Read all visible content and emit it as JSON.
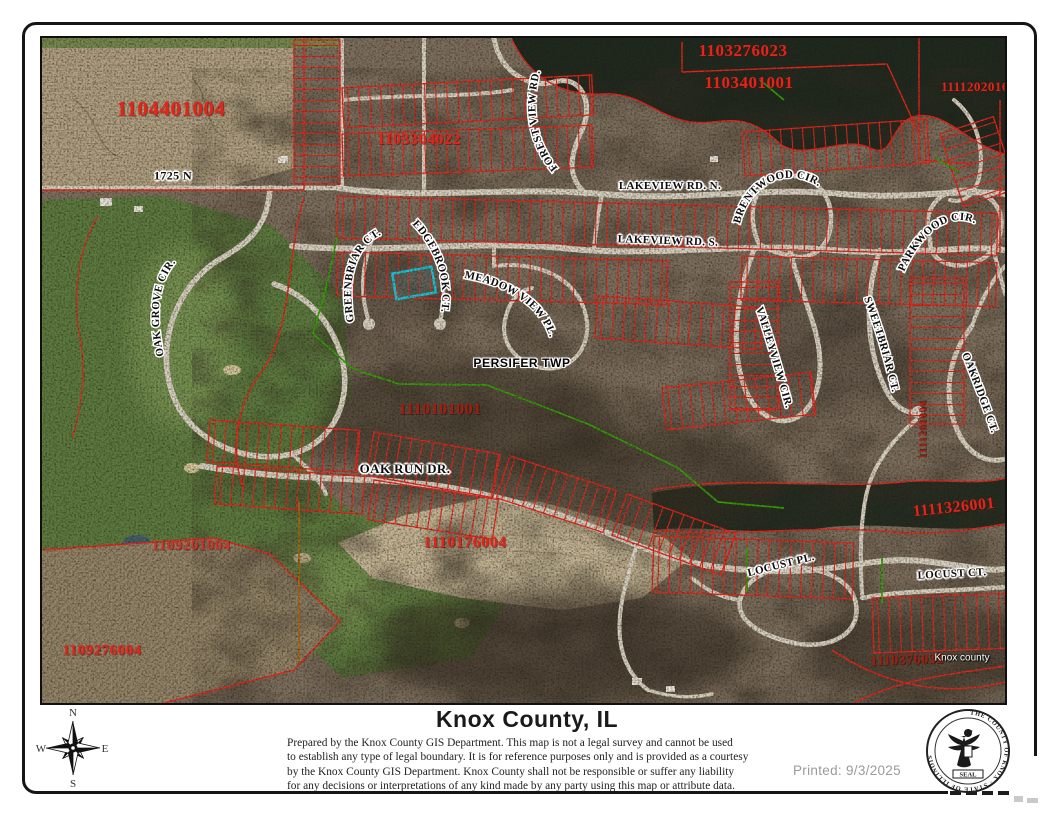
{
  "footer": {
    "title": "Knox County, IL",
    "disclaimer_lines": [
      "Prepared by the Knox County GIS Department. This map is not a legal survey and cannot be used",
      "to establish any type of legal boundary. It is for reference purposes only and is provided as a courtesy",
      "by the Knox County GIS Department.  Knox County shall not be responsible or suffer any liability",
      "for any decisions or interpretations of any kind made by any party using this map or attribute data."
    ],
    "printed_label": "Printed: 9/3/2025",
    "compass": {
      "n": "N",
      "e": "E",
      "s": "S",
      "w": "W"
    },
    "seal": {
      "ring_text": "THE COUNTY OF KNOX · STATE OF ILLINOIS",
      "banner": "SEAL"
    }
  },
  "map": {
    "highlight_color": "#1ac8dc",
    "parcel_line_color": "#e8261c",
    "labels": [
      {
        "name": "parcel-label-1104401004",
        "text": "1104401004",
        "cls": "parcel",
        "x": 129,
        "y": 71,
        "size": 21
      },
      {
        "name": "parcel-label-1103276023",
        "text": "1103276023",
        "cls": "parcel",
        "x": 701,
        "y": 13,
        "size": 17
      },
      {
        "name": "parcel-label-1103401001",
        "text": "1103401001",
        "cls": "parcel",
        "x": 707,
        "y": 45,
        "size": 17
      },
      {
        "name": "parcel-label-1111202016",
        "text": "1111202016",
        "cls": "parcel",
        "x": 933,
        "y": 49,
        "size": 13
      },
      {
        "name": "parcel-label-1103304022",
        "text": "1103304022",
        "cls": "parcel",
        "x": 377,
        "y": 102,
        "size": 16
      },
      {
        "name": "parcel-label-1110101001",
        "text": "1110101001",
        "cls": "parcel dark",
        "x": 398,
        "y": 372,
        "size": 16
      },
      {
        "name": "parcel-label-1110176004",
        "text": "1110176004",
        "cls": "parcel",
        "x": 423,
        "y": 505,
        "size": 16
      },
      {
        "name": "parcel-label-1109201004",
        "text": "1109201004",
        "cls": "parcel dim",
        "x": 149,
        "y": 508,
        "size": 15
      },
      {
        "name": "parcel-label-1109276004",
        "text": "1109276004",
        "cls": "parcel",
        "x": 60,
        "y": 613,
        "size": 15
      },
      {
        "name": "parcel-label-1111326001",
        "text": "1111326001",
        "cls": "parcel",
        "x": 912,
        "y": 470,
        "size": 16,
        "rot": -6
      },
      {
        "name": "parcel-label-1111201004",
        "text": "1111201004",
        "cls": "parcel dark",
        "x": 881,
        "y": 392,
        "size": 11,
        "rot": -90
      },
      {
        "name": "parcel-label-1110376032",
        "text": "1110376032",
        "cls": "parcel dark",
        "x": 865,
        "y": 623,
        "size": 14,
        "rot": -2
      },
      {
        "name": "street-label-1725-n",
        "text": "1725 N",
        "cls": "street",
        "x": 131,
        "y": 138,
        "size": 12
      },
      {
        "name": "street-label-lakeview-rd-n",
        "text": "LAKEVIEW RD. N.",
        "cls": "street",
        "x": 628,
        "y": 148,
        "size": 11
      },
      {
        "name": "street-label-lakeview-rd-s",
        "text": "LAKEVIEW RD. S.",
        "cls": "street",
        "x": 626,
        "y": 203,
        "size": 11,
        "rot": 2
      },
      {
        "name": "street-label-oak-run-dr",
        "text": "OAK RUN DR.",
        "cls": "street",
        "x": 363,
        "y": 431,
        "size": 13
      },
      {
        "name": "street-label-locust-pl",
        "text": "LOCUST PL.",
        "cls": "street",
        "x": 739,
        "y": 527,
        "size": 11,
        "rot": -14
      },
      {
        "name": "street-label-locust-ct",
        "text": "LOCUST CT.",
        "cls": "street",
        "x": 910,
        "y": 536,
        "size": 11,
        "rot": -3
      },
      {
        "name": "township-label-persifer",
        "text": "PERSIFER TWP",
        "cls": "twp",
        "x": 480,
        "y": 325,
        "size": 12
      },
      {
        "name": "watermark-knox-county",
        "text": "Knox county",
        "cls": "wm",
        "x": 920,
        "y": 620,
        "size": 10
      },
      {
        "name": "street-label-forest-view-rd",
        "text": "FOREST VIEW RD.",
        "path": "path-forestview"
      },
      {
        "name": "street-label-brentwood-cir",
        "text": "BRENTWOOD CIR.",
        "path": "path-brentwood"
      },
      {
        "name": "street-label-parkwood-cir",
        "text": "PARKWOOD CIR.",
        "path": "path-parkwood"
      },
      {
        "name": "street-label-oak-grove-cir",
        "text": "OAK GROVE CIR.",
        "path": "path-oakgrove"
      },
      {
        "name": "street-label-greenbriar-ct",
        "text": "GREENBRIAR CT.",
        "path": "path-greenbriar"
      },
      {
        "name": "street-label-edgebrook-ct",
        "text": "EDGEBROOK CT.",
        "path": "path-edgebrook"
      },
      {
        "name": "street-label-meadow-view-pl",
        "text": "MEADOW VIEW PL.",
        "path": "path-meadowview"
      },
      {
        "name": "street-label-valleyview-cir",
        "text": "VALLEYVIEW CIR.",
        "path": "path-valleyview"
      },
      {
        "name": "street-label-sweetbriar-ct",
        "text": "SWEETBRIAR CT.",
        "path": "path-sweetbriar"
      },
      {
        "name": "street-label-oakridge-ct",
        "text": "OAKRIDGE CT.",
        "path": "path-oakridge"
      }
    ]
  }
}
